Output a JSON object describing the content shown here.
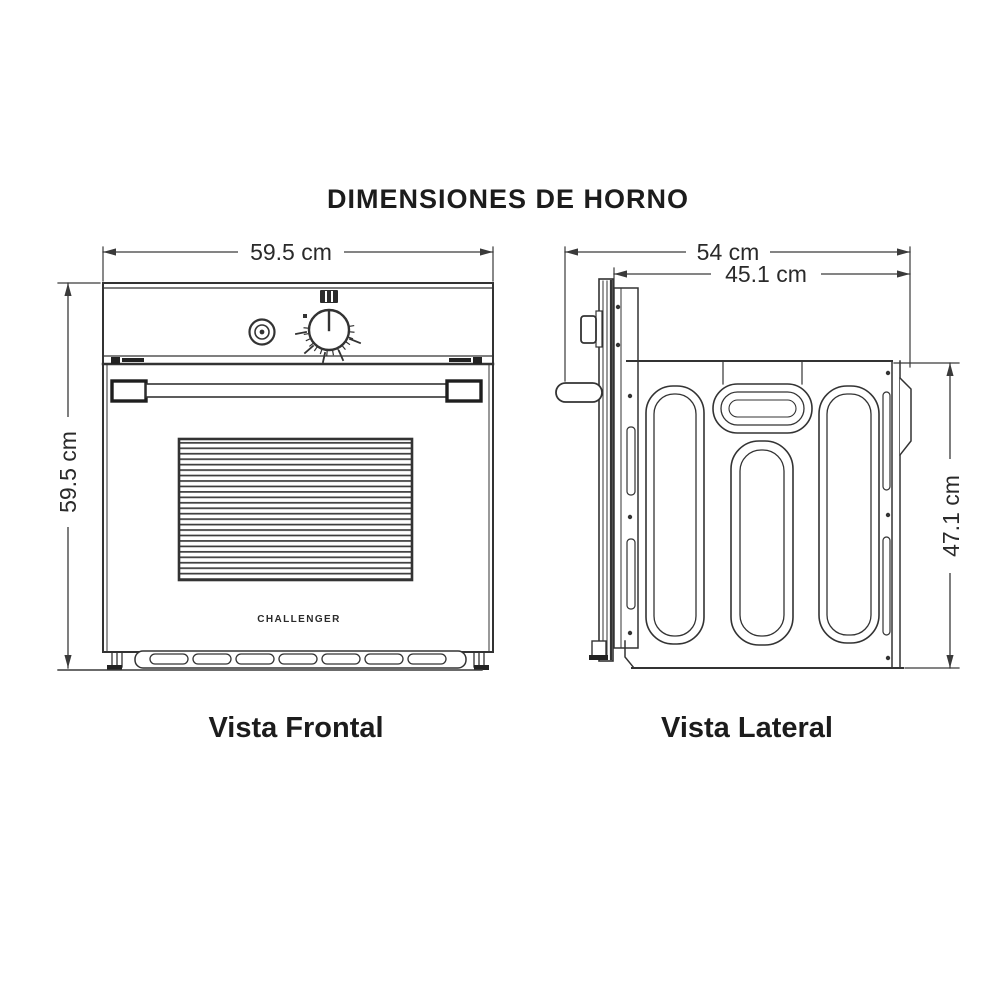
{
  "title": "DIMENSIONES DE HORNO",
  "brand_logo": "CHALLENGER",
  "front_view": {
    "label": "Vista Frontal",
    "width_dim": "59.5 cm",
    "height_dim": "59.5 cm"
  },
  "side_view": {
    "label": "Vista Lateral",
    "total_depth_dim": "54 cm",
    "body_depth_dim": "45.1 cm",
    "body_height_dim": "47.1 cm"
  },
  "icons": {
    "grill_mode": "grill-mode-icon",
    "indicator_light": "indicator-light-icon",
    "control_knob": "control-knob-icon"
  },
  "colors": {
    "line": "#333333",
    "dimension_line": "#3a3a3a",
    "text": "#1c1c1c",
    "background": "#ffffff"
  }
}
